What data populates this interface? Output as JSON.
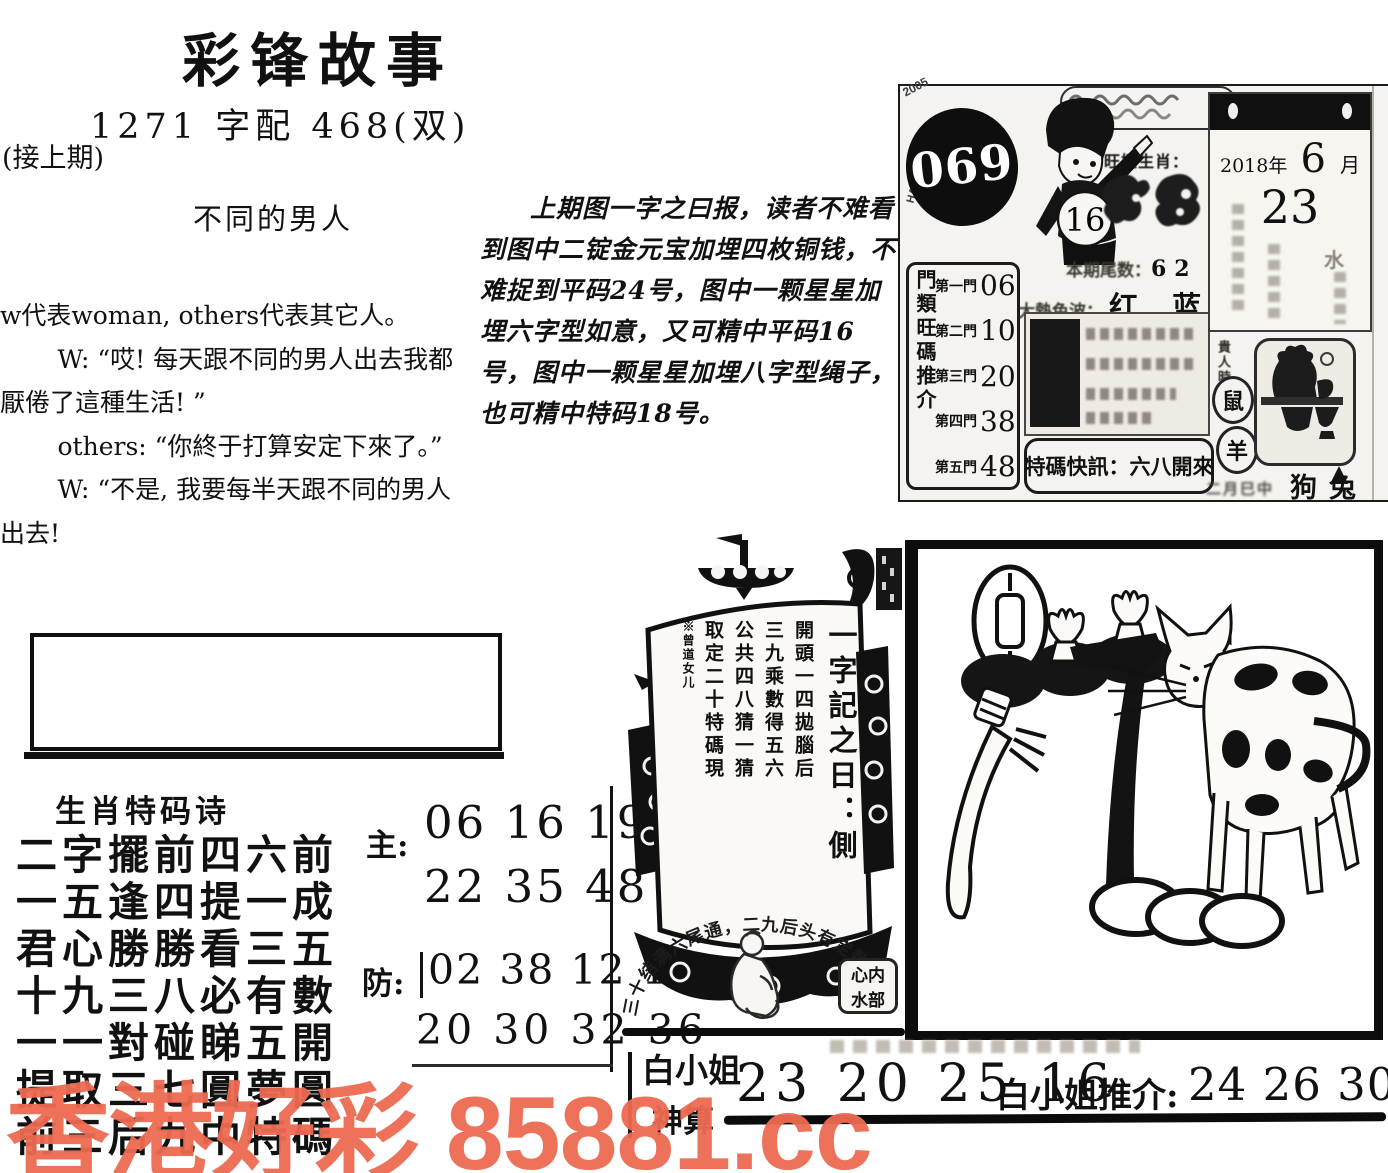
{
  "page": {
    "title": "彩锋故事",
    "subtitle": "1271 字配 468(双)",
    "continued": "(接上期)",
    "story_title": "不同的男人",
    "story": {
      "intro": "w代表woman, others代表其它人。",
      "lines": [
        "W: “哎! 每天跟不同的男人出去我都厭倦了這種生活! ”",
        "others: “你終于打算安定下來了。”",
        "W: “不是, 我要每半天跟不同的男人出去!"
      ]
    },
    "analysis": "上期图一字之曰报，读者不难看到图中二锭金元宝加埋四枚铜钱，不难捉到平码24号，图中一颗星星加埋六字型如意，又可精中平码16号，图中一颗星星加埋八字型绳子，也可精中特码18号。"
  },
  "card": {
    "issue": "069",
    "side_year": "2005",
    "side_brand": "HAIMARK SIX",
    "boy_number": "16",
    "masthead": "旺極生肖：",
    "tail_label": "本期尾数：",
    "tail_value": "62",
    "wave_label": "大熱色波：",
    "wave_value": "红 蓝",
    "doors_label": "門類旺碼推介",
    "doors": [
      {
        "label": "第一門",
        "value": "06"
      },
      {
        "label": "第二門",
        "value": "10"
      },
      {
        "label": "第三門",
        "value": "20"
      },
      {
        "label": "第四門",
        "value": "38"
      },
      {
        "label": "第五門",
        "value": "48"
      }
    ],
    "flash": "特碼快訊：六八開來",
    "calendar": {
      "year": "2018年",
      "month": "6",
      "month_unit": "月",
      "day": "23",
      "faint_char": "水"
    },
    "noble_label": "貴人時",
    "zodiac_circles": [
      "鼠",
      "羊"
    ],
    "corner_note": "二月巳中",
    "corner_animals": "狗兔"
  },
  "poem": {
    "heading": "生肖特码诗",
    "lines": [
      "二字擺前四六前",
      "一五逢四提一成",
      "君心勝勝看三五",
      "十九三八必有數",
      "一一對碰睇五開",
      "提取三七圓夢圓",
      "前三后九中特碼"
    ],
    "main_label": "主:",
    "main_rows": [
      "06 16 19",
      "22 35 48"
    ],
    "guard_label": "防:",
    "guard_rows": [
      "02 38 12 18",
      "20 30 32 36"
    ]
  },
  "ship": {
    "sail_cols": [
      "一字記之日：側",
      "開頭一四拋腦后",
      "三九乘數得五六",
      "公共四八猜一猜",
      "取定二十特碼現",
      "※曾道女儿"
    ],
    "arc_text": "三十结满六尾通，二九后头有定数",
    "seal_rows": [
      "心内",
      "水部"
    ]
  },
  "footer": {
    "tipster": "白小姐",
    "tipster2": "神算",
    "numbers": "23 20 25 16",
    "recommend_label": "白小姐推介:",
    "recommend_numbers": "24 26 30 32 36"
  },
  "watermark": {
    "text": "香港好彩 85881.cc",
    "color": "#ee6a52"
  }
}
